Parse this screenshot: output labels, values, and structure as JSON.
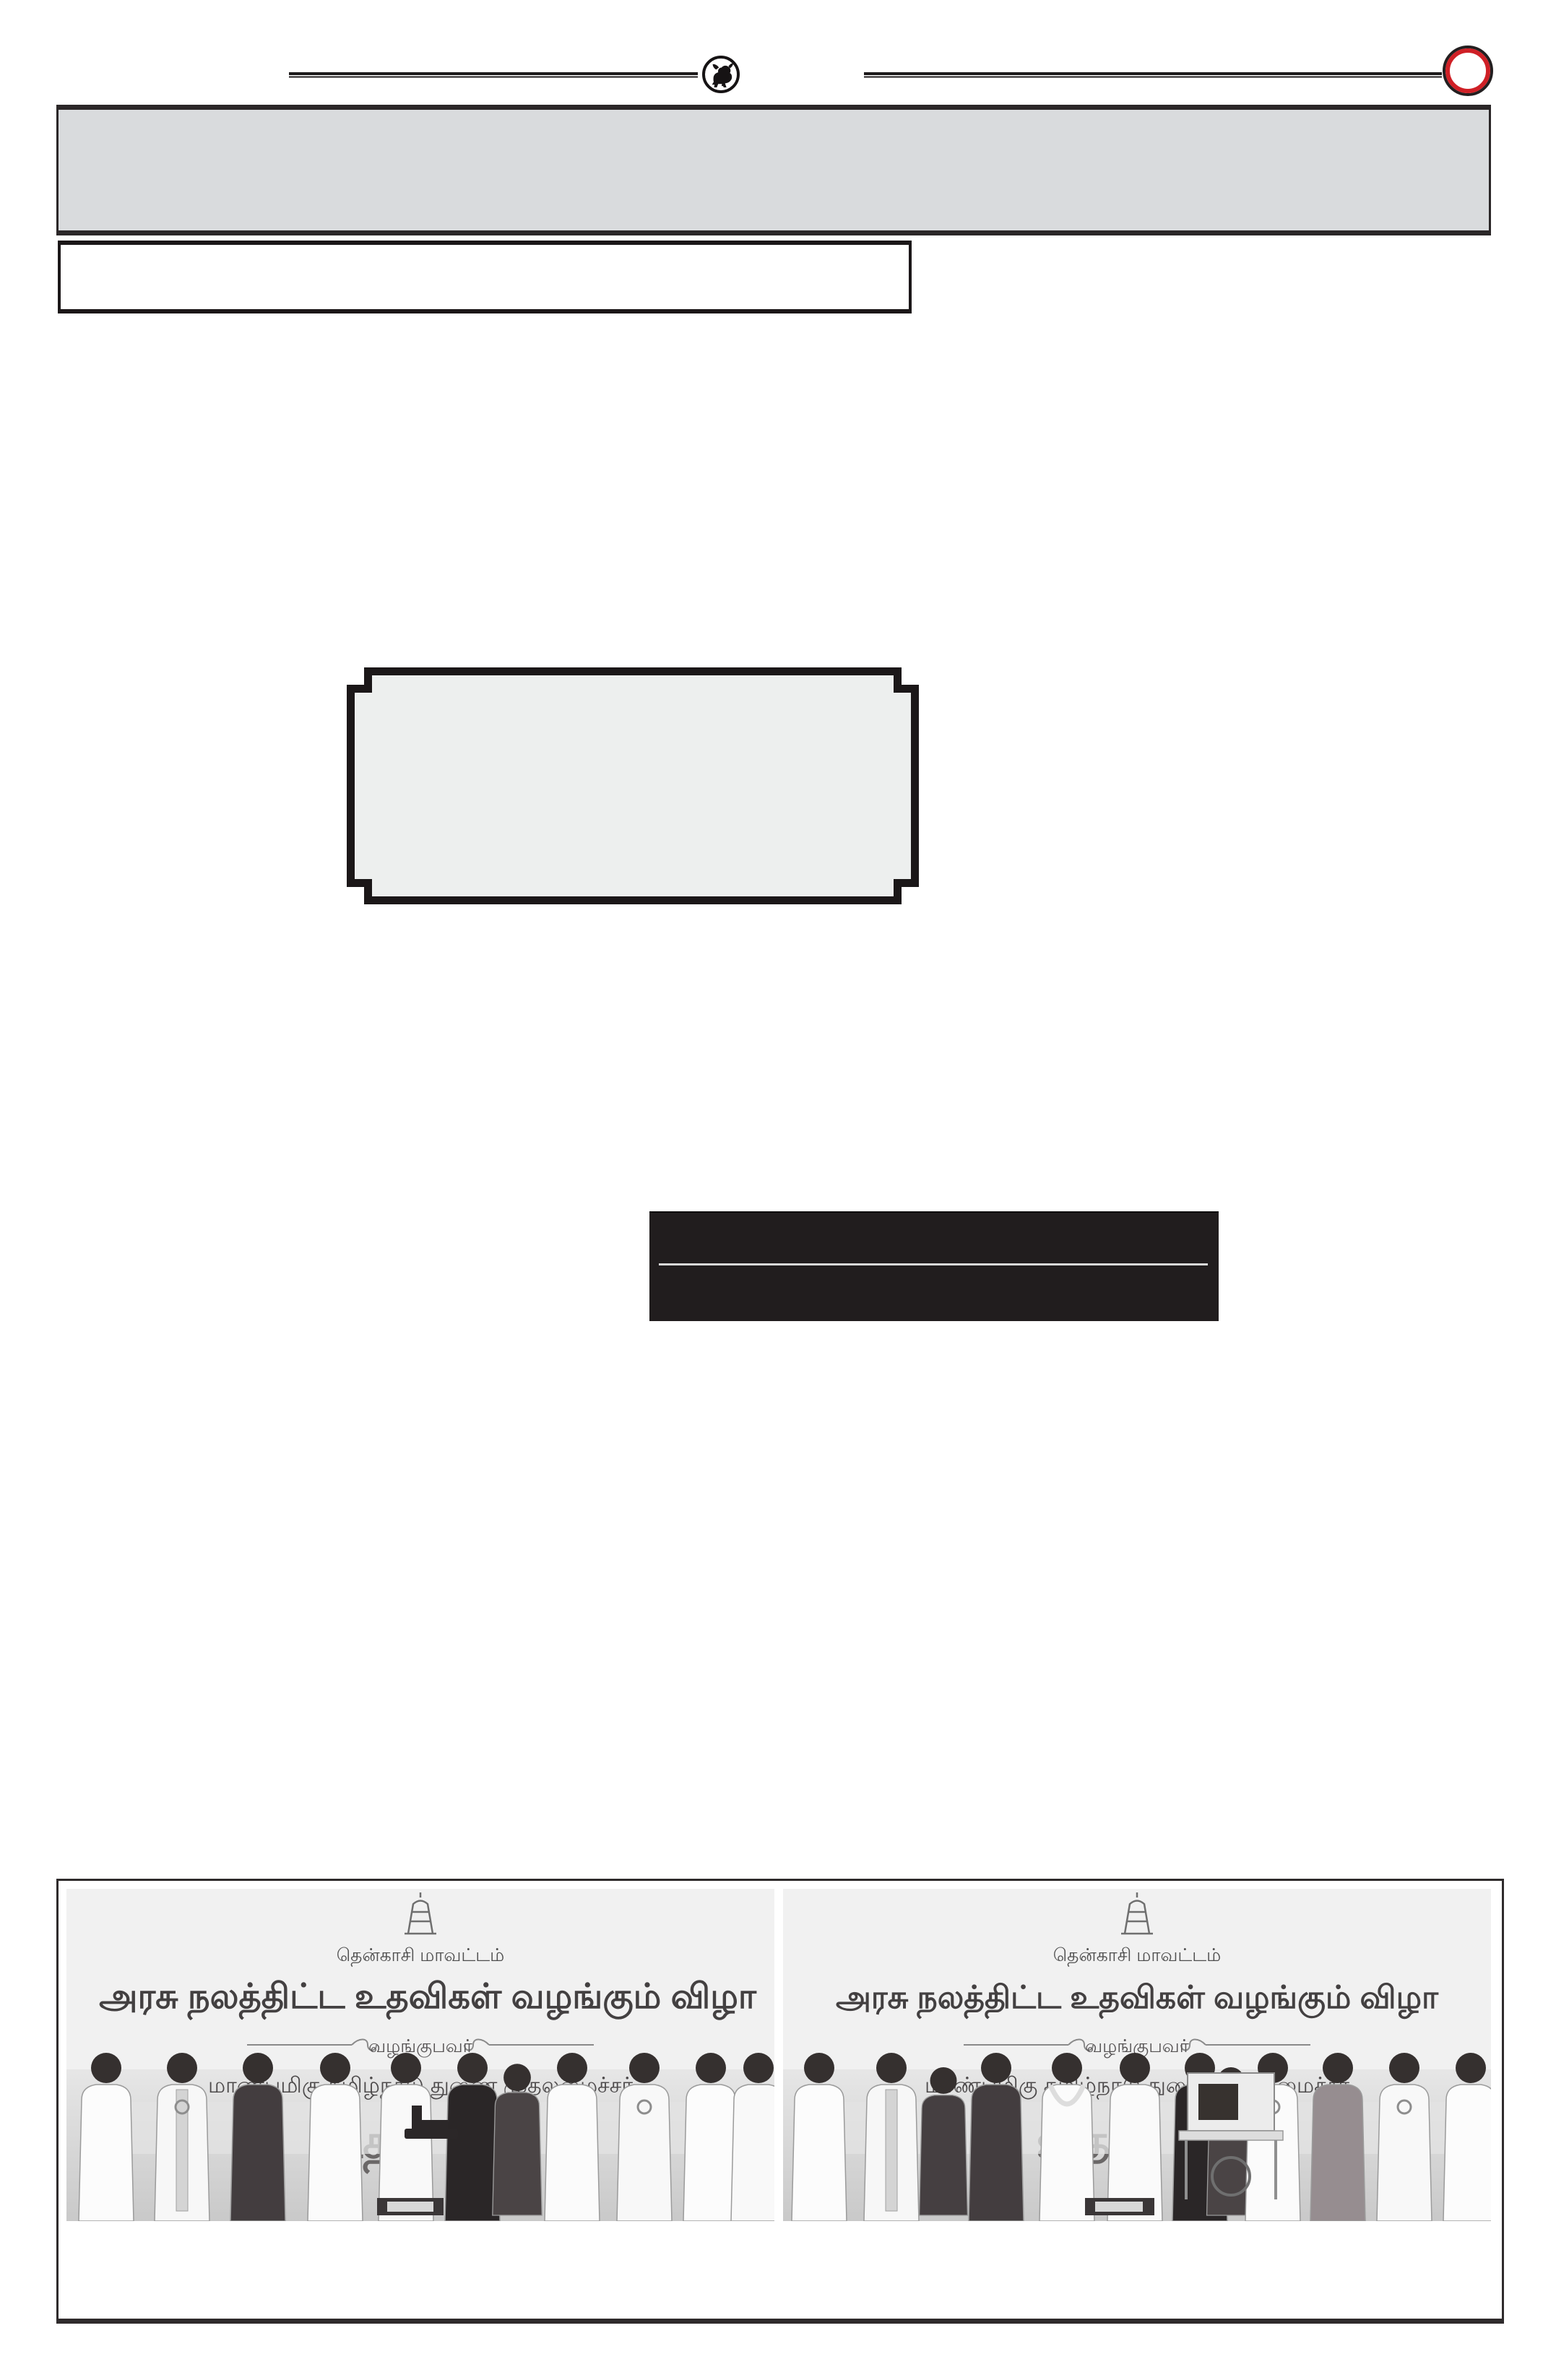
{
  "header": {
    "bull_logo": "bull-emblem",
    "accent_red": "#cf2026",
    "ink_black": "#1d1a1b"
  },
  "decor": {
    "masthead_banner_fill": "#d9dbdd",
    "plaque_fill": "#edefee",
    "highlight_box_fill": "#211d1e",
    "highlight_divider_color": "#d9d9d9"
  },
  "photos": {
    "left": {
      "district": "தென்காசி மாவட்டம்",
      "title": "அரசு நலத்திட்ட உதவிகள் வழங்கும் விழா",
      "presenter": "வழங்குபவர்",
      "minister": "மாண்புமிகு தமிழ்நாடு துணை முதலமைச்சர்",
      "stage_name_partial": "உதய"
    },
    "right": {
      "district": "தென்காசி மாவட்டம்",
      "title": "அரசு நலத்திட்ட உதவிகள் வழங்கும் விழா",
      "presenter": "வழங்குபவர்",
      "minister": "மாண்புமிகு தமிழ்நாடு துணை முதலமைச்சர்",
      "stage_name_partial": "உதய"
    }
  }
}
